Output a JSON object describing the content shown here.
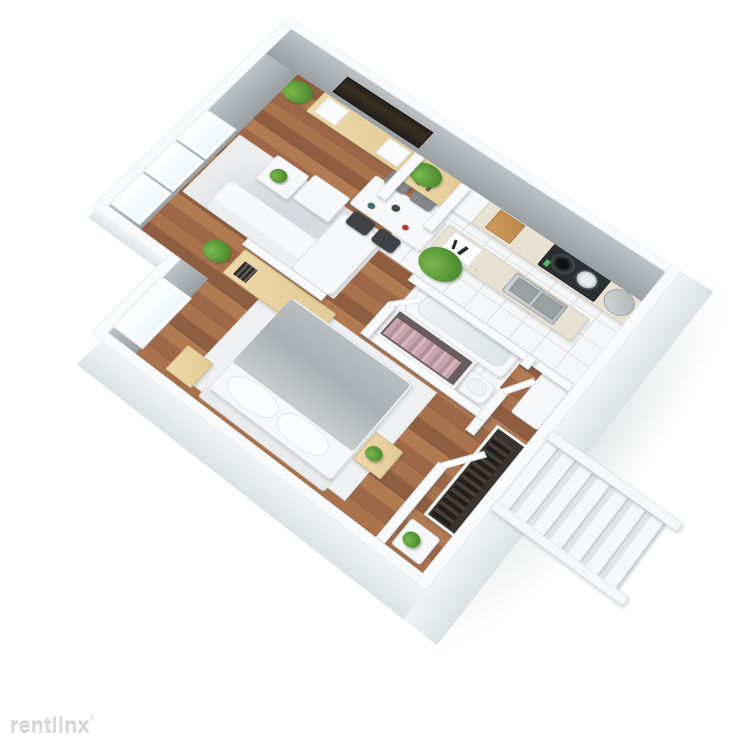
{
  "watermark": {
    "text": "rentlinx",
    "mark": "ʼ"
  },
  "palette": {
    "background": "#ffffff",
    "wall_interior": "#9aa1a5",
    "wall_top": "#f9fafb",
    "wall_exterior": "#e7ebed",
    "floor_wood": "#a9734e",
    "floor_tile": "#f4f6f7",
    "rug": "#eaecee",
    "white_furniture": "#f6f7f8",
    "wood_furniture": "#e9d3a4",
    "plant_green": "#5a9a35",
    "tv_screen": "#262019",
    "countertop": "#e9e2d2",
    "cooktop": "#2c3033",
    "steel": "#c6cacd",
    "clothes_pink": "#c2a0ac",
    "clothes_dark": "#332d29",
    "stairs": "#f3f5f6",
    "watermark_gray": "#d9d9d9"
  },
  "scene": {
    "type": "3d-floor-plan",
    "view": "isometric cutaway render on white background",
    "windows_count": 4,
    "rooms": [
      {
        "name": "living-room",
        "floor": "hardwood",
        "furniture": [
          "sofa",
          "area-rug",
          "coffee-table",
          "coffee-table-with-plant",
          "tv-console",
          "wall-mounted-tv",
          "potted-plant",
          "potted-plant",
          "sideboard-with-books",
          "floor-plant"
        ]
      },
      {
        "name": "dining-area",
        "floor": "hardwood",
        "furniture": [
          "dining-table",
          "gray-chair",
          "gray-chair",
          "dark-chair",
          "dark-chair",
          "table-setting"
        ]
      },
      {
        "name": "kitchen",
        "floor": "white-tile",
        "furniture": [
          "island-counter",
          "double-sink",
          "cutting-board",
          "tall-cabinet",
          "wall-counter",
          "gas-cooktop",
          "corner-sink",
          "wood-board"
        ]
      },
      {
        "name": "desk-nook",
        "floor": "hardwood",
        "furniture": [
          "desk-with-shelves",
          "large-potted-plant"
        ]
      },
      {
        "name": "bedroom",
        "floor": "hardwood",
        "furniture": [
          "double-bed-gray-blanket",
          "area-rug",
          "nightstand",
          "nightstand-with-plant",
          "window"
        ]
      },
      {
        "name": "bathroom",
        "floor": "white-tile",
        "furniture": [
          "bathtub",
          "wash-basin",
          "open-closet-pink-clothes"
        ]
      },
      {
        "name": "hallway",
        "floor": "hardwood",
        "furniture": [
          "wardrobe-dark-clothes",
          "white-console-cabinet",
          "side-table-with-plant"
        ]
      },
      {
        "name": "staircase",
        "floor": "none",
        "furniture": [
          "stair-flight-descending",
          "railing",
          "railing",
          "landing"
        ]
      }
    ]
  }
}
